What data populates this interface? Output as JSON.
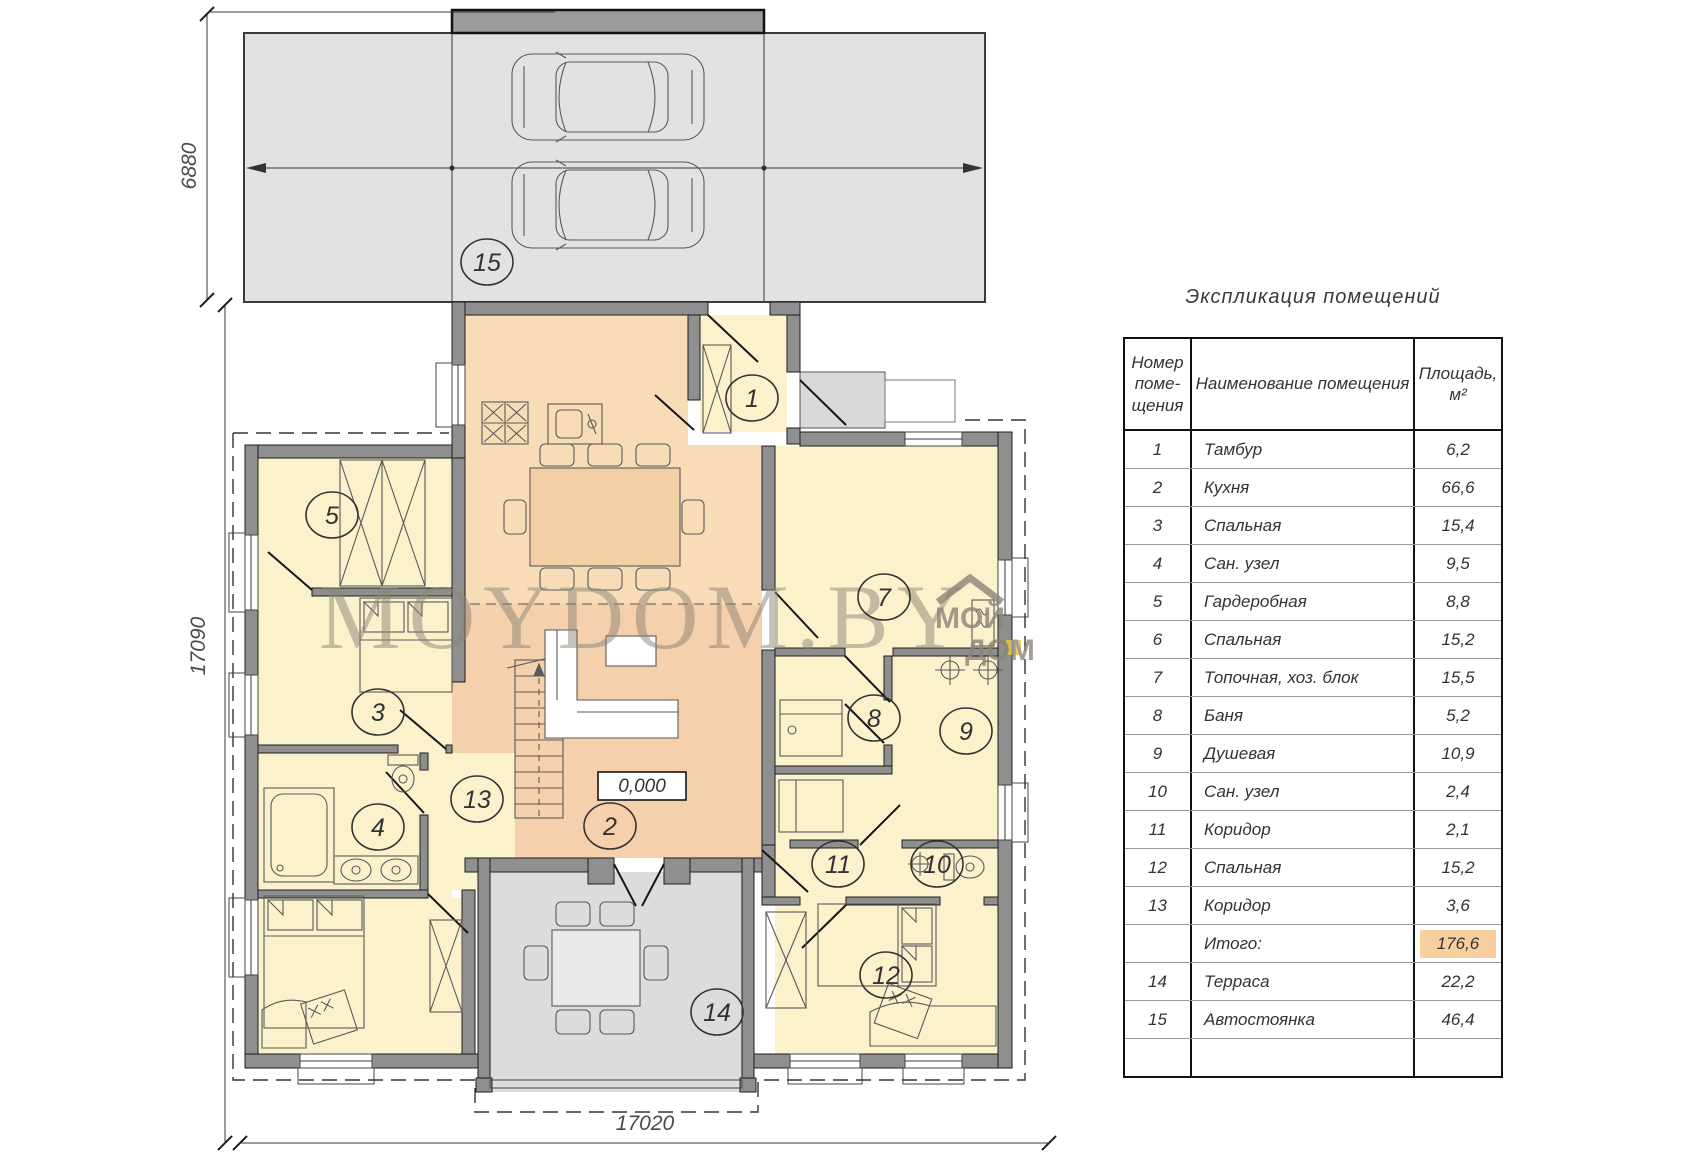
{
  "plan": {
    "watermark": "MOYDOM.BY",
    "logo": {
      "line1": "МОЙ",
      "line2": "ДОМ",
      "accent_color": "#e8c93e"
    },
    "level_mark": "0,000",
    "dimensions": {
      "parking_depth": "6880",
      "house_depth": "17090",
      "house_width": "17020"
    },
    "circles": [
      {
        "label": "15",
        "x": 487,
        "y": 262
      },
      {
        "label": "1",
        "x": 752,
        "y": 398
      },
      {
        "label": "5",
        "x": 332,
        "y": 515
      },
      {
        "label": "3",
        "x": 378,
        "y": 712
      },
      {
        "label": "4",
        "x": 378,
        "y": 827
      },
      {
        "label": "13",
        "x": 477,
        "y": 799
      },
      {
        "label": "2",
        "x": 610,
        "y": 826
      },
      {
        "label": "7",
        "x": 884,
        "y": 597
      },
      {
        "label": "8",
        "x": 874,
        "y": 718
      },
      {
        "label": "9",
        "x": 966,
        "y": 731
      },
      {
        "label": "11",
        "x": 838,
        "y": 864
      },
      {
        "label": "10",
        "x": 937,
        "y": 864
      },
      {
        "label": "12",
        "x": 886,
        "y": 975
      },
      {
        "label": "14",
        "x": 717,
        "y": 1012
      }
    ],
    "colors": {
      "kitchen": "#f8dcb8",
      "living": "#f5d0ac",
      "room_yellow": "#fbf2cc",
      "terrace": "#dcdcdc",
      "parking": "#e2e2e2",
      "canopy": "#9b9b9b",
      "wall": "#8f8f8f"
    }
  },
  "schedule": {
    "title": "Экспликация помещений",
    "headers": {
      "number": "Номер\nпоме-\nщения",
      "name": "Наименование помещения",
      "area": "Площадь,\nм²"
    },
    "highlight_color": "#f8cf9e",
    "rows": [
      {
        "number": "1",
        "name": "Тамбур",
        "area": "6,2"
      },
      {
        "number": "2",
        "name": "Кухня",
        "area": "66,6"
      },
      {
        "number": "3",
        "name": "Спальная",
        "area": "15,4"
      },
      {
        "number": "4",
        "name": "Сан. узел",
        "area": "9,5"
      },
      {
        "number": "5",
        "name": "Гардеробная",
        "area": "8,8"
      },
      {
        "number": "6",
        "name": "Спальная",
        "area": "15,2"
      },
      {
        "number": "7",
        "name": "Топочная, хоз. блок",
        "area": "15,5"
      },
      {
        "number": "8",
        "name": "Баня",
        "area": "5,2"
      },
      {
        "number": "9",
        "name": "Душевая",
        "area": "10,9"
      },
      {
        "number": "10",
        "name": "Сан. узел",
        "area": "2,4"
      },
      {
        "number": "11",
        "name": "Коридор",
        "area": "2,1"
      },
      {
        "number": "12",
        "name": "Спальная",
        "area": "15,2"
      },
      {
        "number": "13",
        "name": "Коридор",
        "area": "3,6"
      },
      {
        "number": "",
        "name": "Итого:",
        "area": "176,6",
        "highlight": true
      },
      {
        "number": "14",
        "name": "Терраса",
        "area": "22,2"
      },
      {
        "number": "15",
        "name": "Автостоянка",
        "area": "46,4"
      },
      {
        "number": "",
        "name": "",
        "area": ""
      }
    ]
  }
}
